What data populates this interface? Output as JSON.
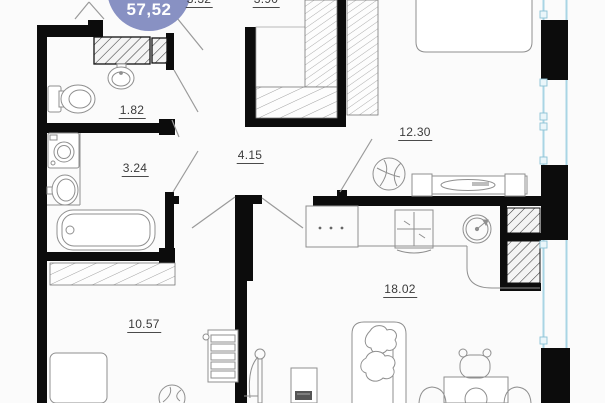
{
  "floor_plan": {
    "badge": {
      "value": "57,52",
      "bg_color": "#8891c3",
      "text_color": "#ffffff"
    },
    "area_labels": [
      {
        "room": "wc",
        "value": "1.82"
      },
      {
        "room": "bathroom",
        "value": "3.24"
      },
      {
        "room": "hallway",
        "value": "4.15"
      },
      {
        "room": "wardrobe-left",
        "value": "3.32"
      },
      {
        "room": "wardrobe-right",
        "value": "3.90"
      },
      {
        "room": "bedroom",
        "value": "12.30"
      },
      {
        "room": "kitchen-living",
        "value": "18.02"
      },
      {
        "room": "bedroom-2",
        "value": "10.57"
      }
    ],
    "colors": {
      "wall": "#0c0c0c",
      "furniture-line": "#8f8f8f",
      "window-glazing": "#a9d5e4",
      "background": "#fbfbfb"
    }
  }
}
